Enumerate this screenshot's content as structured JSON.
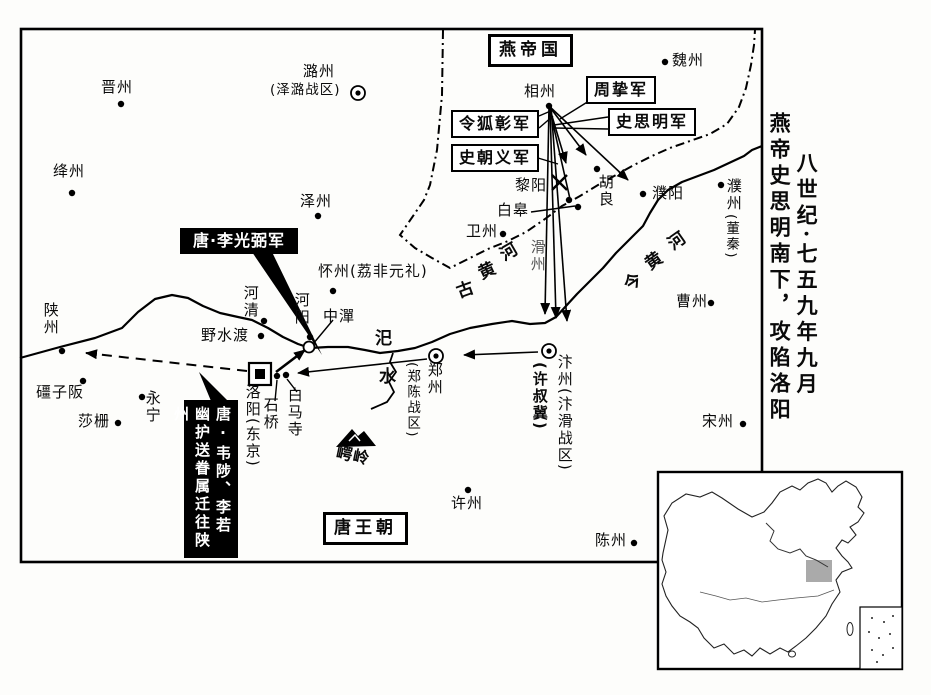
{
  "title": {
    "line1": "八世纪·七五九年九月",
    "line2": "燕帝史思明南下，攻陷洛阳"
  },
  "regions": {
    "yan": "燕帝国",
    "tang": "唐王朝"
  },
  "armies": {
    "zhouzhi": "周挚军",
    "shisiming": "史思明军",
    "linghuzhang": "令狐彰军",
    "shichaoyi": "史朝义军",
    "li_guangbi": "唐·李光弼军",
    "escort": "唐·韦陟、李若幽护送眷属迁往陕州"
  },
  "places": {
    "jinzhou": "晋州",
    "jiangzhou": "绛州",
    "luzhou": "潞州",
    "luzhou_note": "(泽潞战区)",
    "zezhou": "泽州",
    "weizhou_n": "魏州",
    "xiangzhou": "相州",
    "liyang": "黎阳",
    "baigao": "白皋",
    "weizhou_w": "卫州",
    "huliang": "胡良",
    "puyang": "濮阳",
    "puzhou": "濮州",
    "puzhou_note": "(董秦)",
    "huazhou": "滑州",
    "caozhou": "曹州",
    "songzhou": "宋州",
    "xuzhou": "许州",
    "chenzhou": "陈州",
    "huaizhou": "怀州(荔非元礼)",
    "heqing": "河清",
    "heyang": "河阳",
    "zhongtan": "中潬",
    "yeshudu": "野水渡",
    "shanzhou": "陕州",
    "jiangziban": "礓子阪",
    "yongning": "永宁",
    "shazha": "莎栅",
    "luoyang": "洛阳(东京)",
    "baimasi": "白马寺",
    "shiqiao": "石桥",
    "zhengzhou": "郑州",
    "zhengzhou_note": "(郑陈战区)",
    "bianzhou": "汴州(汴滑战区)",
    "bianzhou_note": "(许叔冀)",
    "eling": "崿岭"
  },
  "rivers": {
    "old": "古黄河",
    "now": "今黄河",
    "sishui": "汜水"
  }
}
